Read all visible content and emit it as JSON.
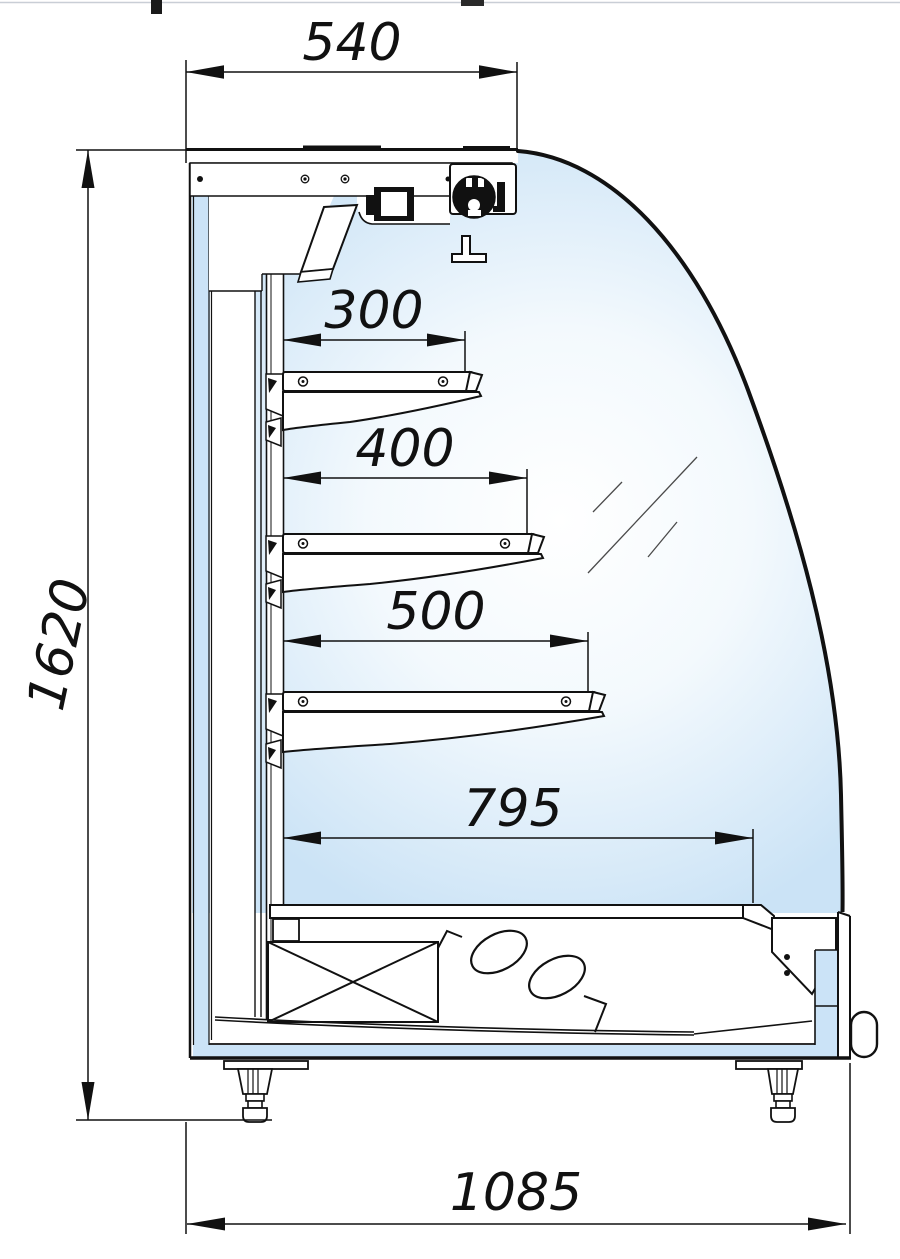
{
  "dims": {
    "top_depth": "540",
    "overall_height": "1620",
    "shelf1_depth": "300",
    "shelf2_depth": "400",
    "shelf3_depth": "500",
    "base_shelf_depth": "795",
    "overall_depth": "1085"
  },
  "colors": {
    "line": "#111111",
    "insulation_blue": "#cbe3f7",
    "interior_blue_edge": "#cde4f6",
    "interior_white": "#ffffff",
    "background": "#ffffff"
  }
}
